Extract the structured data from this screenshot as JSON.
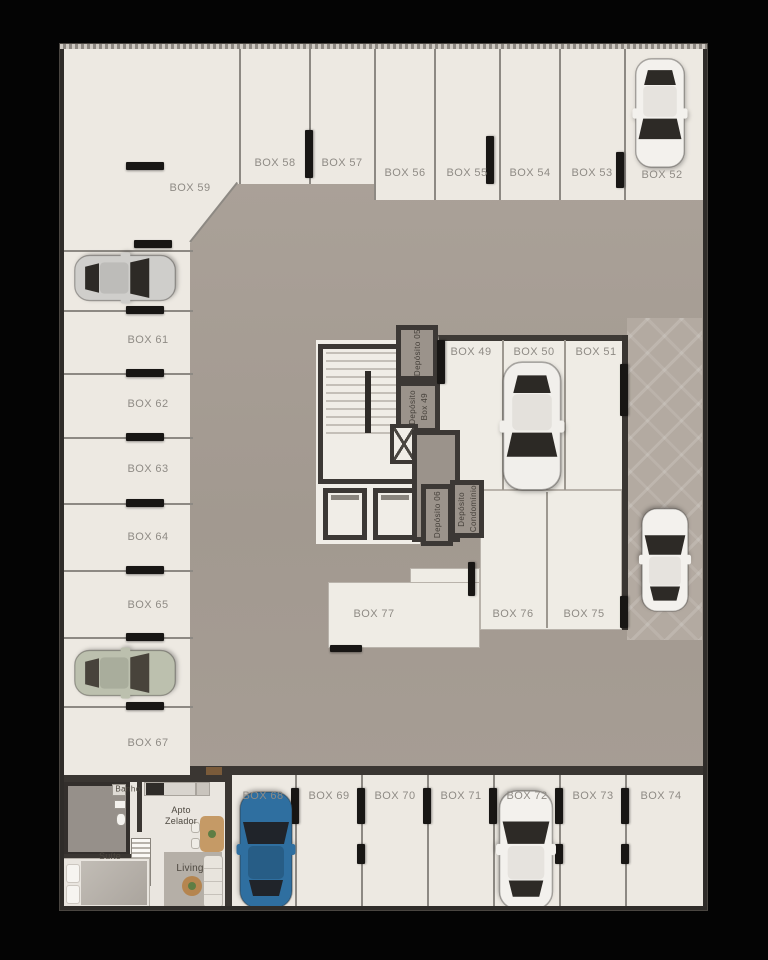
{
  "scene": {
    "type": "floor-plan",
    "name": "garage-parking-level"
  },
  "boxes": {
    "top_row": [
      "BOX 58",
      "BOX 57",
      "BOX 56",
      "BOX 55",
      "BOX 54",
      "BOX 53",
      "BOX 52"
    ],
    "corner": "BOX 59",
    "left_column": [
      "BOX 61",
      "BOX 62",
      "BOX 63",
      "BOX 64",
      "BOX 65",
      "BOX 67"
    ],
    "center_row": [
      "BOX 49",
      "BOX 50",
      "BOX 51"
    ],
    "lower_center": [
      "BOX 77",
      "BOX 76",
      "BOX 75"
    ],
    "bottom_row": [
      "BOX 68",
      "BOX 69",
      "BOX 70",
      "BOX 71",
      "BOX 72",
      "BOX 73",
      "BOX 74"
    ]
  },
  "storage": {
    "dep05": "Depósito 05",
    "dep_box49": [
      "Depósito",
      "Box 49"
    ],
    "dep06": "Depósito 06",
    "dep_condominio": [
      "Depósito",
      "Condomínio"
    ]
  },
  "apartment": {
    "banho": "Banho",
    "apto": [
      "Apto",
      "Zelador"
    ],
    "suite": "Suíte",
    "living": "Living"
  },
  "colors": {
    "floor_box": "#EDE9E2",
    "aisle": "#A89F96",
    "ramp": "#B3AAA1",
    "wall": "#3C3835",
    "label": "#8F8B85",
    "car_white": "#F3F1ED",
    "car_silver": "#CFCECB",
    "car_sage": "#BCC0AE",
    "car_blue": "#2F6FA0"
  }
}
